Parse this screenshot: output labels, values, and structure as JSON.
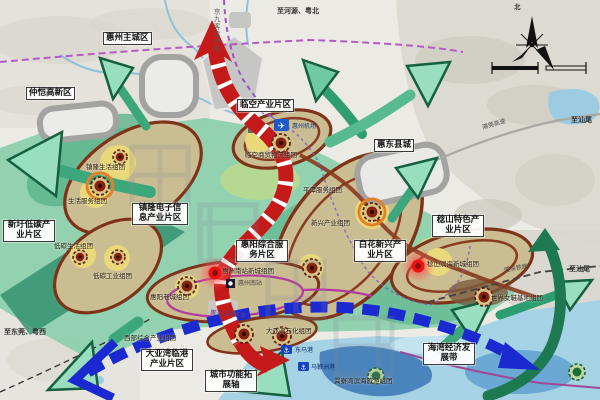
{
  "map": {
    "region_labels": {
      "huizhou_main_city": "惠州主城区",
      "zhongkai_hightech": "仲恺高新区",
      "linkong_industry": "临空产业片区",
      "huidong_county": "惠东县城",
      "zhenlong_electronics": "镇隆电子信息产业片区",
      "xinwei_lowcarbon": "新圩低碳产业片区",
      "huiyang_service": "惠阳综合服务片区",
      "baihua_emerging": "白花新兴产业片区",
      "renshan_special": "稔山特色产业片区",
      "dayawan_port": "大亚湾临港产业片区"
    },
    "axis_labels": {
      "city_function_axis": "城市功能拓展轴",
      "bay_economic_belt": "海湾经济发展带"
    },
    "cluster_labels": {
      "zhenlong_living": "镇隆生活组团",
      "living_service": "生活服务组团",
      "lowcarbon_living": "低碳生活组团",
      "lowcarbon_industry": "低碳工业组团",
      "linkong_trade_logistics": "临空商贸物流组团",
      "pingtan_service": "平潭服务组团",
      "emerging_industry": "新兴产业组团",
      "south_station_newtown": "惠州南站新城组团",
      "huiyang_oldtown": "惠阳老城组团",
      "west_comprehensive": "西部综合产业组团",
      "dayawan_petrochemical": "大亚湾石化组团",
      "renshan_coastal_newtown": "稔山滨海新城组团",
      "world_shoe_base": "世界女鞋基地组团",
      "xunliao_tourism": "巽寮湾滨海旅游组团"
    },
    "transport_labels": {
      "jingjiu_rail": "京九客运专线",
      "chaoguan_expressway": "潮莞高速",
      "xiashen_railway": "厦深铁路",
      "yanhai_expressway": "惠深沿海高速",
      "huizhou_airport": "惠州机场",
      "huizhou_south_station": "惠州南站",
      "dongma_port": "东马港",
      "mabianzhou_port": "马鞭洲港"
    },
    "edge_labels": {
      "to_heyuan_north": "至河源、粤北",
      "to_dongguan_west": "至东莞、粤西",
      "to_shanwei_upper": "至汕尾",
      "to_shanwei_lower": "至汕尾"
    },
    "compass": {
      "north": "北"
    },
    "colors": {
      "axis_red": "#c41a1a",
      "bay_belt_blue": "#1a2ad0",
      "corridor_green": "#3da77c",
      "zone_ring_brown": "#7e3318",
      "planning_teal": "#8bcfad",
      "sea_blue": "#a6d2e6"
    }
  }
}
